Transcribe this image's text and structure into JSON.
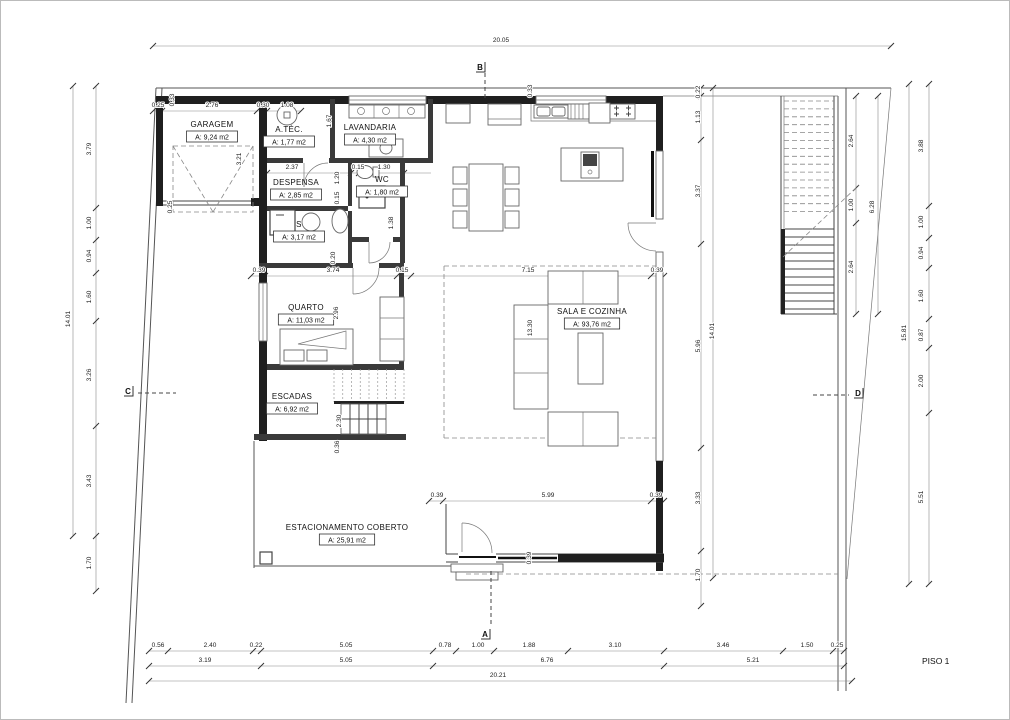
{
  "title": {
    "plan_label": "PISO 1"
  },
  "colors": {
    "background": "#ffffff",
    "wall": "#1f1f1f",
    "line": "#444444",
    "dim_text": "#222222"
  },
  "rooms": [
    {
      "name": "GARAGEM",
      "area": "A: 9,24 m2",
      "x": 211,
      "y": 126
    },
    {
      "name": "A.TÉC.",
      "area": "A: 1,77 m2",
      "x": 288,
      "y": 131
    },
    {
      "name": "LAVANDARIA",
      "area": "A: 4,30 m2",
      "x": 369,
      "y": 129
    },
    {
      "name": "DESPENSA",
      "area": "A: 2,85 m2",
      "x": 295,
      "y": 184
    },
    {
      "name": "WC",
      "area": "A: 1,80 m2",
      "x": 381,
      "y": 181
    },
    {
      "name": "S",
      "area": "A: 3,17 m2",
      "x": 298,
      "y": 226
    },
    {
      "name": "QUARTO",
      "area": "A: 11,03 m2",
      "x": 305,
      "y": 309
    },
    {
      "name": "ESCADAS",
      "area": "A: 6,92 m2",
      "x": 291,
      "y": 398
    },
    {
      "name": "SALA E COZINHA",
      "area": "A: 93,76 m2",
      "x": 591,
      "y": 313
    },
    {
      "name": "ESTACIONAMENTO COBERTO",
      "area": "A: 25,91 m2",
      "x": 346,
      "y": 529
    }
  ],
  "dimensions": [
    {
      "t": "20.05",
      "x": 500,
      "y": 41
    },
    {
      "t": "0.25",
      "x": 157,
      "y": 106
    },
    {
      "t": "2.76",
      "x": 211,
      "y": 106
    },
    {
      "t": "0.30",
      "x": 262,
      "y": 106
    },
    {
      "t": "1.08",
      "x": 286,
      "y": 106
    },
    {
      "t": "2.37",
      "x": 291,
      "y": 168
    },
    {
      "t": "0.15",
      "x": 357,
      "y": 168
    },
    {
      "t": "1.30",
      "x": 383,
      "y": 168
    },
    {
      "t": "0.39",
      "x": 258,
      "y": 271
    },
    {
      "t": "3.74",
      "x": 332,
      "y": 271
    },
    {
      "t": "0.15",
      "x": 401,
      "y": 271
    },
    {
      "t": "7.15",
      "x": 527,
      "y": 271
    },
    {
      "t": "0.39",
      "x": 656,
      "y": 271
    },
    {
      "t": "0.39",
      "x": 436,
      "y": 496
    },
    {
      "t": "5.99",
      "x": 547,
      "y": 496
    },
    {
      "t": "0.39",
      "x": 655,
      "y": 496
    },
    {
      "t": "0.56",
      "x": 157,
      "y": 646
    },
    {
      "t": "2.40",
      "x": 209,
      "y": 646
    },
    {
      "t": "0.22",
      "x": 255,
      "y": 646
    },
    {
      "t": "5.05",
      "x": 345,
      "y": 646
    },
    {
      "t": "0.78",
      "x": 444,
      "y": 646
    },
    {
      "t": "1.00",
      "x": 477,
      "y": 646
    },
    {
      "t": "1.88",
      "x": 528,
      "y": 646
    },
    {
      "t": "3.10",
      "x": 614,
      "y": 646
    },
    {
      "t": "3.46",
      "x": 722,
      "y": 646
    },
    {
      "t": "1.50",
      "x": 806,
      "y": 646
    },
    {
      "t": "0.25",
      "x": 836,
      "y": 646
    },
    {
      "t": "3.19",
      "x": 204,
      "y": 661
    },
    {
      "t": "5.05",
      "x": 345,
      "y": 661
    },
    {
      "t": "6.76",
      "x": 546,
      "y": 661
    },
    {
      "t": "5.21",
      "x": 752,
      "y": 661
    },
    {
      "t": "20.21",
      "x": 497,
      "y": 676
    },
    {
      "t": "3.79",
      "x": 90,
      "y": 148,
      "r": 1
    },
    {
      "t": "1.00",
      "x": 90,
      "y": 222,
      "r": 1
    },
    {
      "t": "0.94",
      "x": 90,
      "y": 255,
      "r": 1
    },
    {
      "t": "1.60",
      "x": 90,
      "y": 296,
      "r": 1
    },
    {
      "t": "3.26",
      "x": 90,
      "y": 374,
      "r": 1
    },
    {
      "t": "3.43",
      "x": 90,
      "y": 480,
      "r": 1
    },
    {
      "t": "1.70",
      "x": 90,
      "y": 562,
      "r": 1
    },
    {
      "t": "14.01",
      "x": 69,
      "y": 318,
      "r": 1
    },
    {
      "t": "0.22",
      "x": 699,
      "y": 91,
      "r": 1
    },
    {
      "t": "1.13",
      "x": 699,
      "y": 116,
      "r": 1
    },
    {
      "t": "3.37",
      "x": 699,
      "y": 190,
      "r": 1
    },
    {
      "t": "5.96",
      "x": 699,
      "y": 345,
      "r": 1
    },
    {
      "t": "3.33",
      "x": 699,
      "y": 497,
      "r": 1
    },
    {
      "t": "1.70",
      "x": 699,
      "y": 574,
      "r": 1
    },
    {
      "t": "14.01",
      "x": 713,
      "y": 330,
      "r": 1
    },
    {
      "t": "2.64",
      "x": 852,
      "y": 140,
      "r": 1
    },
    {
      "t": "1.00",
      "x": 852,
      "y": 204,
      "r": 1
    },
    {
      "t": "2.64",
      "x": 852,
      "y": 266,
      "r": 1
    },
    {
      "t": "6.28",
      "x": 873,
      "y": 206,
      "r": 1
    },
    {
      "t": "3.88",
      "x": 922,
      "y": 145,
      "r": 1
    },
    {
      "t": "1.00",
      "x": 922,
      "y": 221,
      "r": 1
    },
    {
      "t": "0.94",
      "x": 922,
      "y": 252,
      "r": 1
    },
    {
      "t": "1.60",
      "x": 922,
      "y": 295,
      "r": 1
    },
    {
      "t": "0.87",
      "x": 922,
      "y": 334,
      "r": 1
    },
    {
      "t": "2.00",
      "x": 922,
      "y": 380,
      "r": 1
    },
    {
      "t": "5.51",
      "x": 922,
      "y": 496,
      "r": 1
    },
    {
      "t": "15.81",
      "x": 905,
      "y": 332,
      "r": 1
    },
    {
      "t": "0.33",
      "x": 173,
      "y": 99,
      "r": 1
    },
    {
      "t": "3.21",
      "x": 240,
      "y": 158,
      "r": 1
    },
    {
      "t": "0.25",
      "x": 171,
      "y": 206,
      "r": 1
    },
    {
      "t": "1.67",
      "x": 330,
      "y": 120,
      "r": 1
    },
    {
      "t": "1.20",
      "x": 338,
      "y": 177,
      "r": 1
    },
    {
      "t": "0.15",
      "x": 338,
      "y": 197,
      "r": 1
    },
    {
      "t": "1.38",
      "x": 392,
      "y": 222,
      "r": 1
    },
    {
      "t": "0.20",
      "x": 334,
      "y": 257,
      "r": 1
    },
    {
      "t": "2.96",
      "x": 337,
      "y": 312,
      "r": 1
    },
    {
      "t": "2.30",
      "x": 340,
      "y": 420,
      "r": 1
    },
    {
      "t": "0.36",
      "x": 338,
      "y": 446,
      "r": 1
    },
    {
      "t": "13.30",
      "x": 531,
      "y": 327,
      "r": 1
    },
    {
      "t": "0.33",
      "x": 531,
      "y": 90,
      "r": 1
    },
    {
      "t": "0.39",
      "x": 530,
      "y": 557,
      "r": 1
    }
  ],
  "section_markers": [
    {
      "letter": "B",
      "x": 479,
      "y": 66
    },
    {
      "letter": "A",
      "x": 484,
      "y": 633
    },
    {
      "letter": "C",
      "x": 127,
      "y": 390
    },
    {
      "letter": "D",
      "x": 857,
      "y": 392
    }
  ]
}
